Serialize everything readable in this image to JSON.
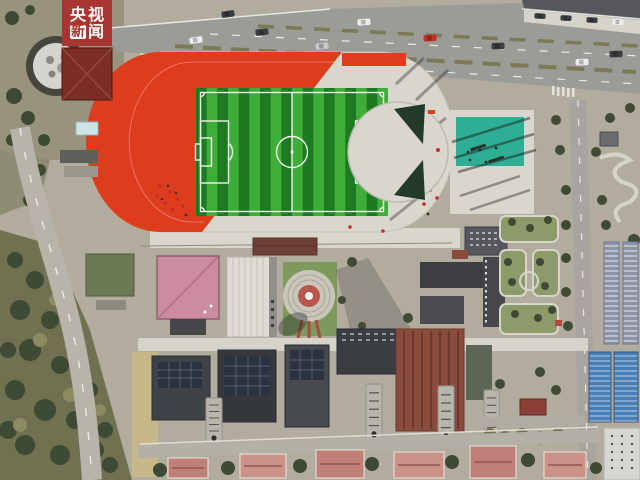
{
  "watermark": {
    "char_1": "央",
    "char_2": "视",
    "char_3": "新",
    "char_4": "闻"
  },
  "scene": {
    "description": "Aerial drone view of a school campus: red running track around a green striped football pitch, teal sports court, campus buildings, gardens, a main road with traffic, and surrounding trees"
  },
  "colors": {
    "ground": "#b2ac9f",
    "park": "#97937d",
    "asphalt": "#9b9b97",
    "path": "#d6d3ca",
    "concrete": "#d9d6ce",
    "track-red": "#dd3c1d",
    "pitch-light": "#3fae38",
    "pitch-dark": "#1d7a22",
    "line-white": "#eef2ea",
    "court-teal": "#2fae96",
    "wedge-dark": "#233a28",
    "roof-pink": "#cb8ba0",
    "roof-maroon": "#6e3f37",
    "roof-brown": "#8a4a3c",
    "roof-dark": "#3a3d42",
    "roof-grey": "#55575c",
    "roof-white": "#dedcd4",
    "roof-blue": "#4a7fb5",
    "roof-slate": "#8b93a7",
    "roof-red": "#7c2e26",
    "tree-dark": "#3e4a33",
    "tree-olive": "#6f7150",
    "grass": "#8f9a6b",
    "lawn": "#7d9a5c",
    "dirt-tan": "#c9b887",
    "logo-red": "#a93530",
    "car-red": "#c03028",
    "car-white": "#eceff0",
    "car-dark": "#3a3d42",
    "car-silver": "#c6c8ca",
    "shadow": "rgba(38,40,46,0.38)"
  }
}
